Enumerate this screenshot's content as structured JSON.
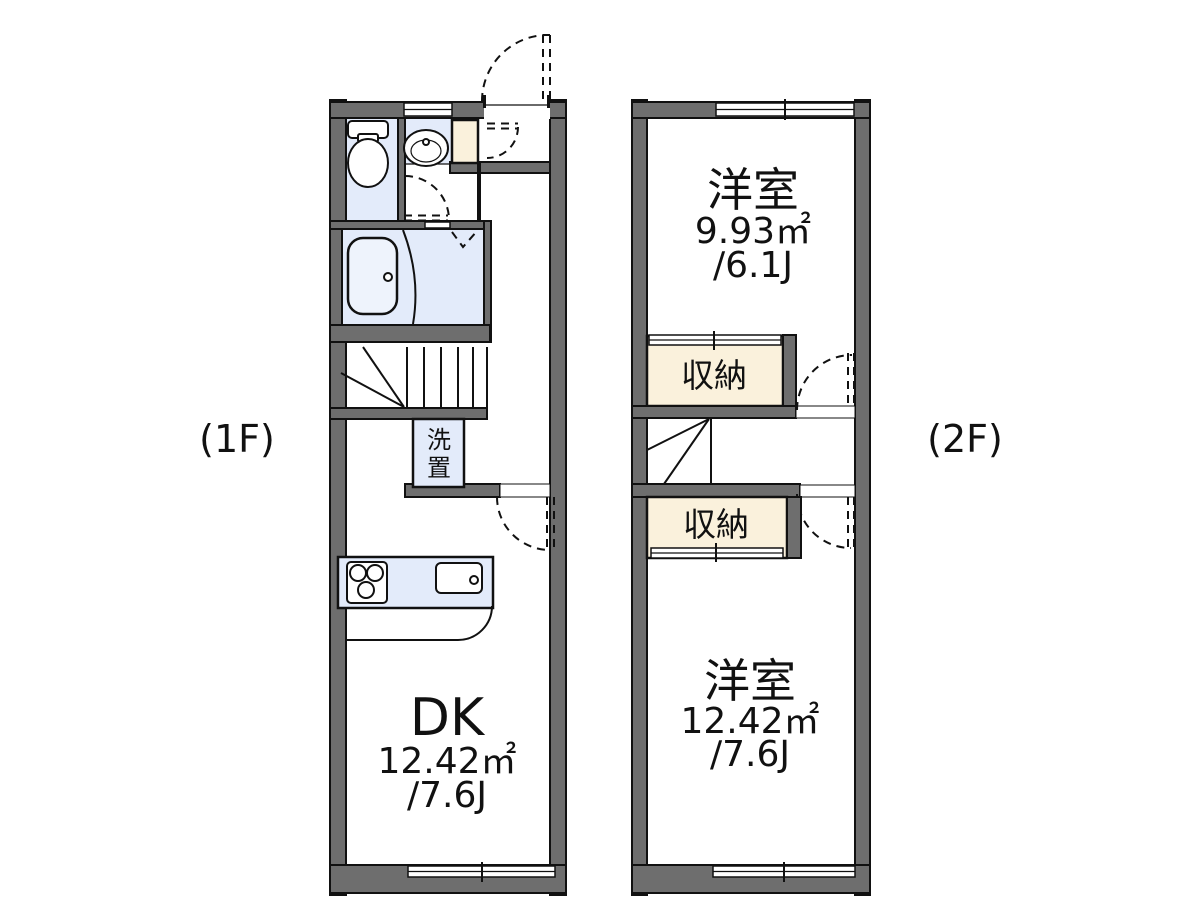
{
  "colors": {
    "wall_gray": "#6e6e6e",
    "fixture_blue": "#e3ebfa",
    "closet_cream": "#faf1dc",
    "line_black": "#111111",
    "background": "#ffffff"
  },
  "floor1": {
    "floor_label": "(1F)",
    "dk_room": {
      "name": "DK",
      "area_sqm": "12.42㎡",
      "area_tatami": "/7.6J"
    },
    "laundry_unit": {
      "char_top": "洗",
      "char_bottom": "置"
    },
    "fixture_names": {
      "toilet": "toilet",
      "washbasin": "washbasin",
      "bathtub": "bathtub",
      "stove": "gas-stove-3-burner",
      "sink": "kitchen-sink",
      "stairs": "winder-staircase",
      "entrance": "entrance-door-swing"
    }
  },
  "floor2": {
    "floor_label": "(2F)",
    "bedroom_upper": {
      "name": "洋室",
      "area_sqm": "9.93㎡",
      "area_tatami": "/6.1J"
    },
    "closet_upper": {
      "name": "収納"
    },
    "closet_lower": {
      "name": "収納"
    },
    "bedroom_lower": {
      "name": "洋室",
      "area_sqm": "12.42㎡",
      "area_tatami": "/7.6J"
    },
    "fixture_names": {
      "stairs": "winder-staircase"
    }
  }
}
